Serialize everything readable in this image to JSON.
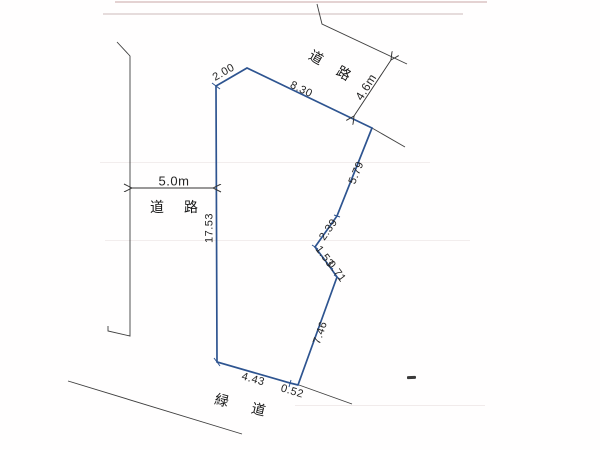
{
  "drawing": {
    "type": "land-survey-plot-plan",
    "outline_color": "#2e5490",
    "line_color": "#3f3f3f",
    "roads": {
      "left": {
        "name": "道 路",
        "width": "5.0m"
      },
      "top": {
        "name": "道 路",
        "width": "4.6m"
      },
      "bottom": {
        "name": "緑 道"
      }
    },
    "plot_edges": [
      {
        "side": "top-left-cut",
        "length": "2.00"
      },
      {
        "side": "top",
        "length": "8.30"
      },
      {
        "side": "right-upper",
        "length": "5.79"
      },
      {
        "side": "right-middle",
        "length": "2.39"
      },
      {
        "side": "notch-upper",
        "length": "1.53"
      },
      {
        "side": "notch-lower",
        "length": "0.71"
      },
      {
        "side": "right-lower",
        "length": "7.46"
      },
      {
        "side": "bottom",
        "length": "4.43"
      },
      {
        "side": "bottom-right-corner",
        "length": "0.52"
      },
      {
        "side": "left",
        "length": "17.53"
      }
    ]
  }
}
